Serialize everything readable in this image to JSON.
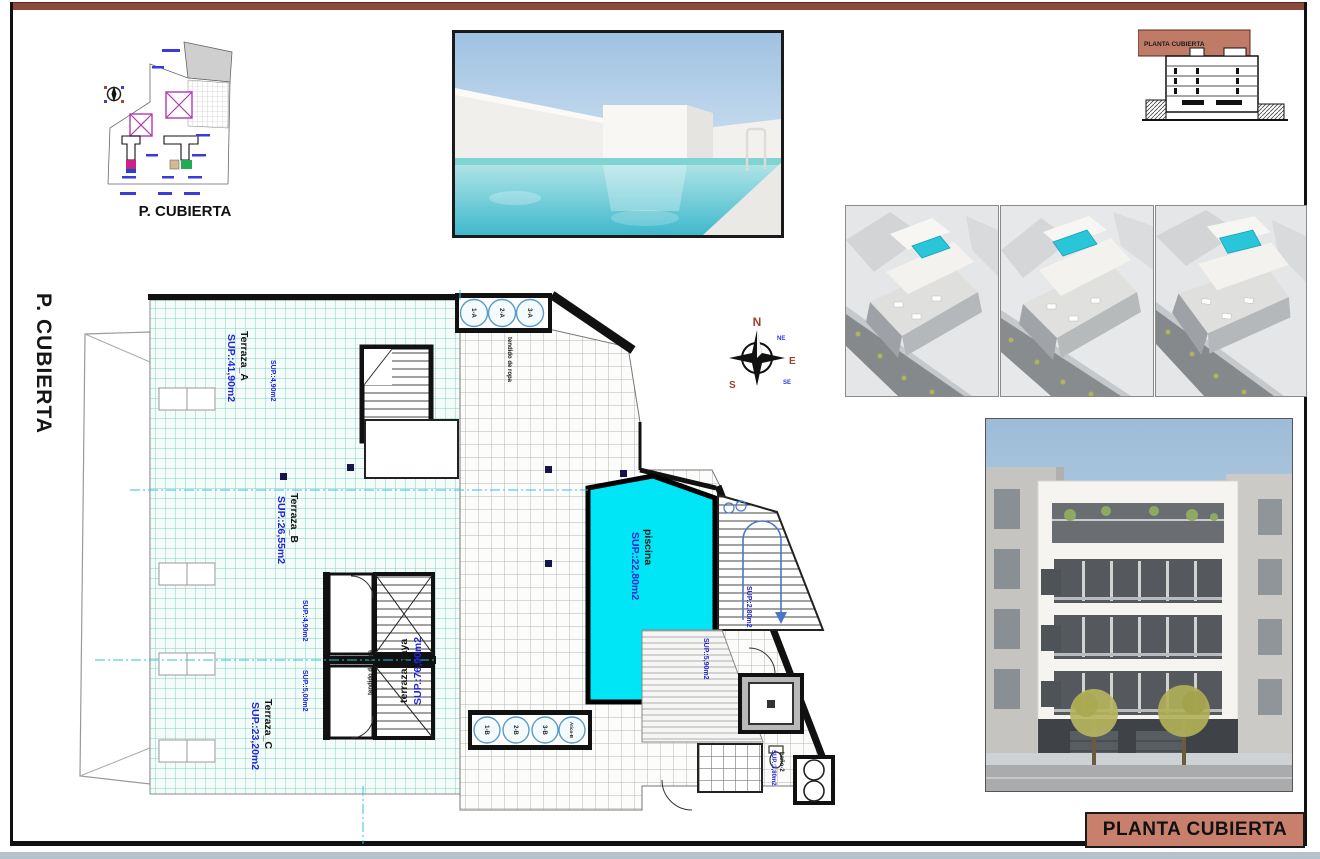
{
  "page": {
    "side_label": "P. CUBIERTA",
    "title_box": "PLANTA CUBIERTA"
  },
  "keyplan": {
    "caption": "P. CUBIERTA"
  },
  "section_thumb": {
    "label": "PLANTA CUBIERTA"
  },
  "compass": {
    "n": "N",
    "e": "E",
    "s": "S",
    "ne": "NE",
    "se": "SE"
  },
  "plan": {
    "rooms": [
      {
        "name": "Terraza_A",
        "sup": "SUP.:41,90m2"
      },
      {
        "name": "Terraza_B",
        "sup": "SUP.:26,55m2"
      },
      {
        "name": "Terraza_C",
        "sup": "SUP.:23,20m2"
      },
      {
        "name": "terraza/playa",
        "sup": "SUP.:76,90m2"
      },
      {
        "name": "piscina",
        "sup": "SUP.:22,80m2"
      }
    ],
    "small_labels": {
      "tendido1": "tendido de ropa",
      "tendido2": "tendido de ropa",
      "sup_stair_top": "SUP.:4,90m2",
      "sup_stair_mid_a": "SUP.:4,90m2",
      "sup_stair_mid_b": "SUP.:5,00m2",
      "sup_stair_right": "SUP.:2,80m2",
      "sup_deck": "SUP.:5,90m2",
      "sup_bano": "SUP.:3,80m2",
      "bano": "baño-2"
    },
    "tanks_top": [
      "1-A",
      "2-A",
      "3-A"
    ],
    "tanks_bottom": [
      "1-B",
      "2-B",
      "3-B",
      "Ático-B"
    ]
  },
  "colors": {
    "accent_salmon": "#c8806c",
    "top_strip": "#8c4a3e",
    "pool_cyan": "#00e6f6",
    "cad_blue": "#2326d8",
    "tile_teal": "#86cfc6"
  }
}
